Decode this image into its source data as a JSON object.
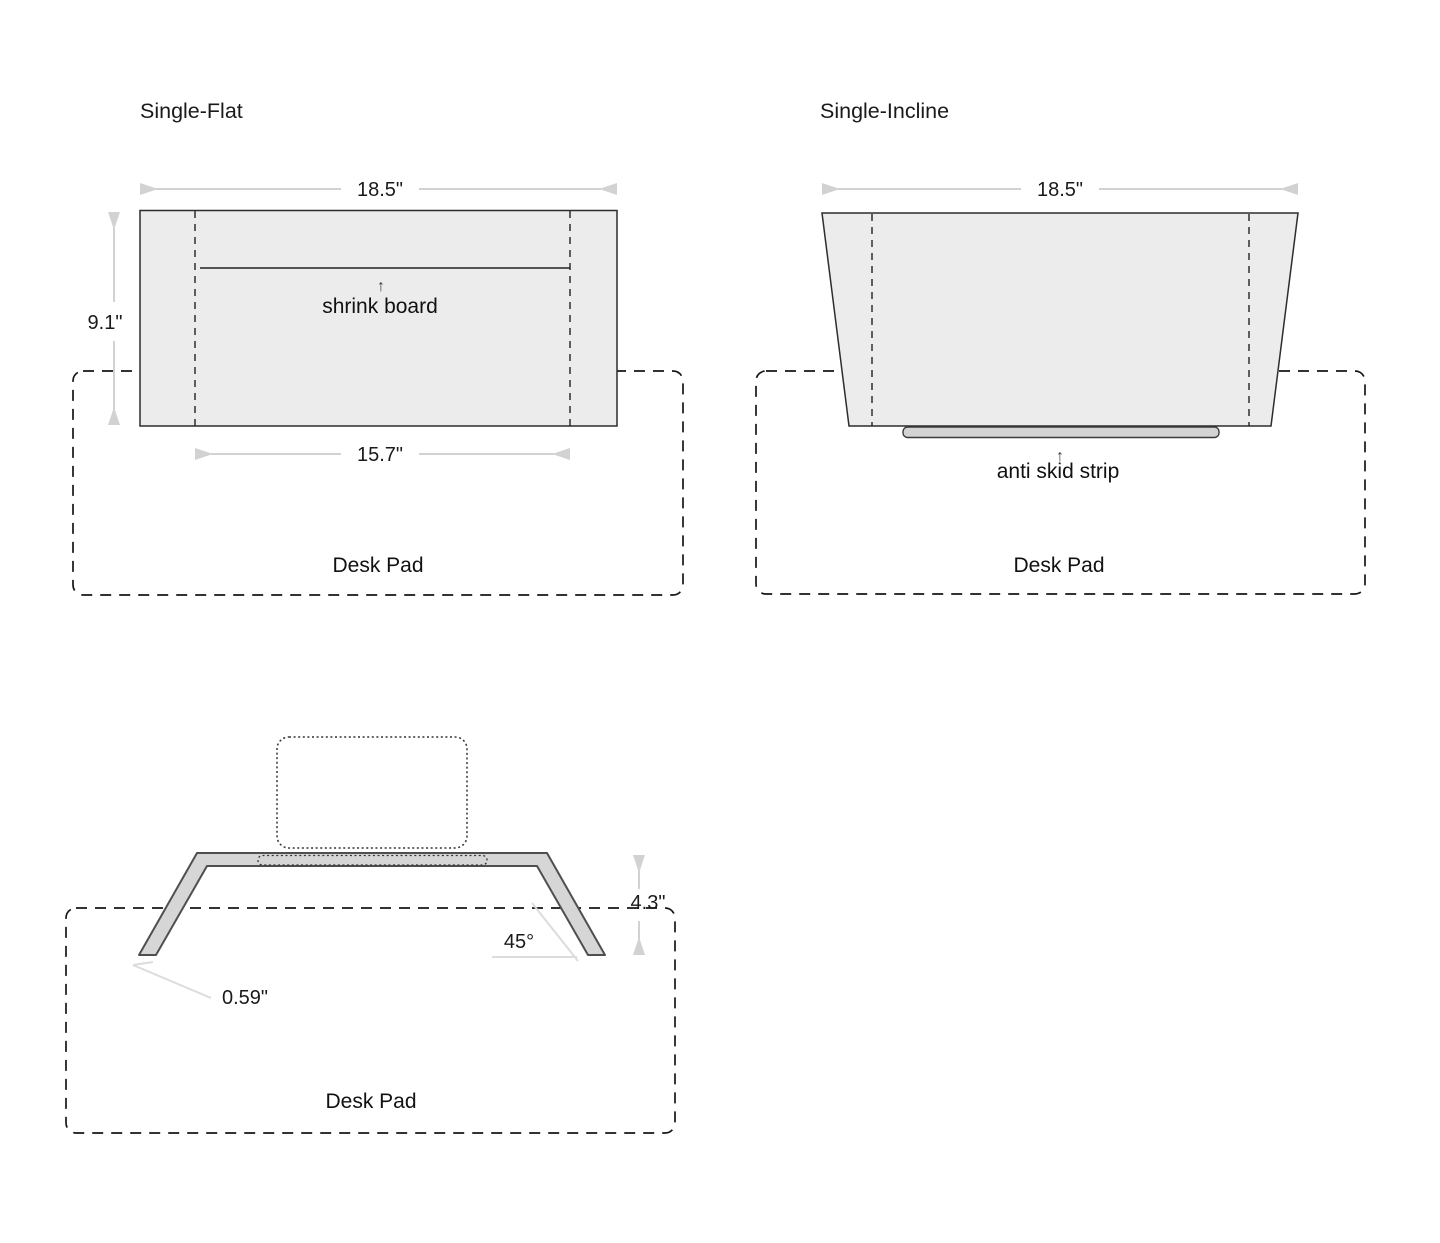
{
  "colors": {
    "background": "#ffffff",
    "shape_fill": "#ececec",
    "shape_stroke": "#2d2d2d",
    "stand_fill": "#d6d6d6",
    "dimension_gray": "#d2d2d2",
    "text": "#1a1a1a"
  },
  "flat": {
    "title": "Single-Flat",
    "width_label": "18.5\"",
    "height_label": "9.1\"",
    "board_width_label": "15.7\"",
    "board_arrow": "↑",
    "board_label": "shrink board",
    "pad_label": "Desk Pad"
  },
  "incline": {
    "title": "Single-Incline",
    "width_label": "18.5\"",
    "strip_arrow": "↑",
    "strip_label": "anti skid strip",
    "pad_label": "Desk Pad"
  },
  "side": {
    "height_label": "4.3\"",
    "angle_label": "45°",
    "thickness_label": "0.59\"",
    "pad_label": "Desk Pad"
  }
}
